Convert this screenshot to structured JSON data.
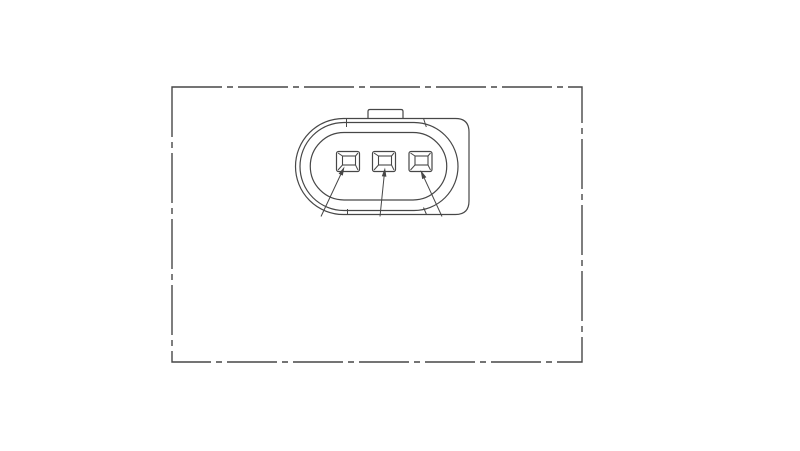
{
  "page": {
    "background": "#ffffff"
  },
  "drawing": {
    "description": "Technical line drawing of a 3-pin oval connector face view inside a phantom-line border frame",
    "line_color": "#474747",
    "canvas": {
      "width": 800,
      "height": 451
    },
    "frame": {
      "name": "phantom-frame",
      "x": 172,
      "y": 87,
      "width": 410,
      "height": 275,
      "dash": "50 5 6 5",
      "stroke_width": 1.4
    },
    "key_tab": {
      "name": "key-tab",
      "path": "M 368 119 V 111.5 Q 368 109.5 370 109.5 H 401 Q 403 109.5 403 111.5 V 119"
    },
    "outlines": [
      {
        "name": "housing-outline-outer",
        "path": "M 343.5 118.5 H 455.5 Q 469 118.5 469 132 V 201 Q 469 214.5 455.5 214.5 H 343.5 A 48 48 0 0 1 343.5 118.5 Z"
      },
      {
        "name": "housing-outline-mid",
        "path": "M 344 122.5 H 414 A 44 44 0 0 1 414 210.5 H 344 A 44 44 0 0 1 344 122.5 Z"
      },
      {
        "name": "housing-outline-inner",
        "path": "M 344 132.5 H 413 A 33.75 33.75 0 0 1 413 200 H 344 A 33.75 33.75 0 0 1 344 132.5 Z"
      }
    ],
    "seam_ticks": [
      {
        "name": "seam-tick-top-left",
        "x1": 346.5,
        "y1": 119,
        "x2": 346.5,
        "y2": 127
      },
      {
        "name": "seam-tick-top-right",
        "x1": 423.7,
        "y1": 119,
        "x2": 426.3,
        "y2": 127
      },
      {
        "name": "seam-tick-bottom-left",
        "x1": 347.5,
        "y1": 209,
        "x2": 347.5,
        "y2": 215
      },
      {
        "name": "seam-tick-bottom-right",
        "x1": 423.5,
        "y1": 207.5,
        "x2": 426.5,
        "y2": 214.5
      }
    ],
    "pins": [
      {
        "name": "pin-1",
        "outer": [
          336.5,
          151.5,
          23,
          20
        ],
        "inner": [
          342.5,
          156,
          13,
          9
        ]
      },
      {
        "name": "pin-2",
        "outer": [
          372.5,
          151.5,
          23,
          20
        ],
        "inner": [
          378.5,
          156,
          13,
          9
        ]
      },
      {
        "name": "pin-3",
        "outer": [
          409,
          151.5,
          23,
          20
        ],
        "inner": [
          415,
          156,
          13,
          9
        ]
      }
    ],
    "leaders": [
      {
        "name": "leader-pin-1",
        "tail": [
          321,
          216.5
        ],
        "tip": [
          344.5,
          166.5
        ]
      },
      {
        "name": "leader-pin-2",
        "tail": [
          380,
          216.5
        ],
        "tip": [
          385,
          167.5
        ]
      },
      {
        "name": "leader-pin-3",
        "tail": [
          442,
          216.5
        ],
        "tip": [
          420.5,
          170
        ]
      }
    ],
    "arrowhead": {
      "length": 9,
      "half_width": 2.3
    }
  }
}
